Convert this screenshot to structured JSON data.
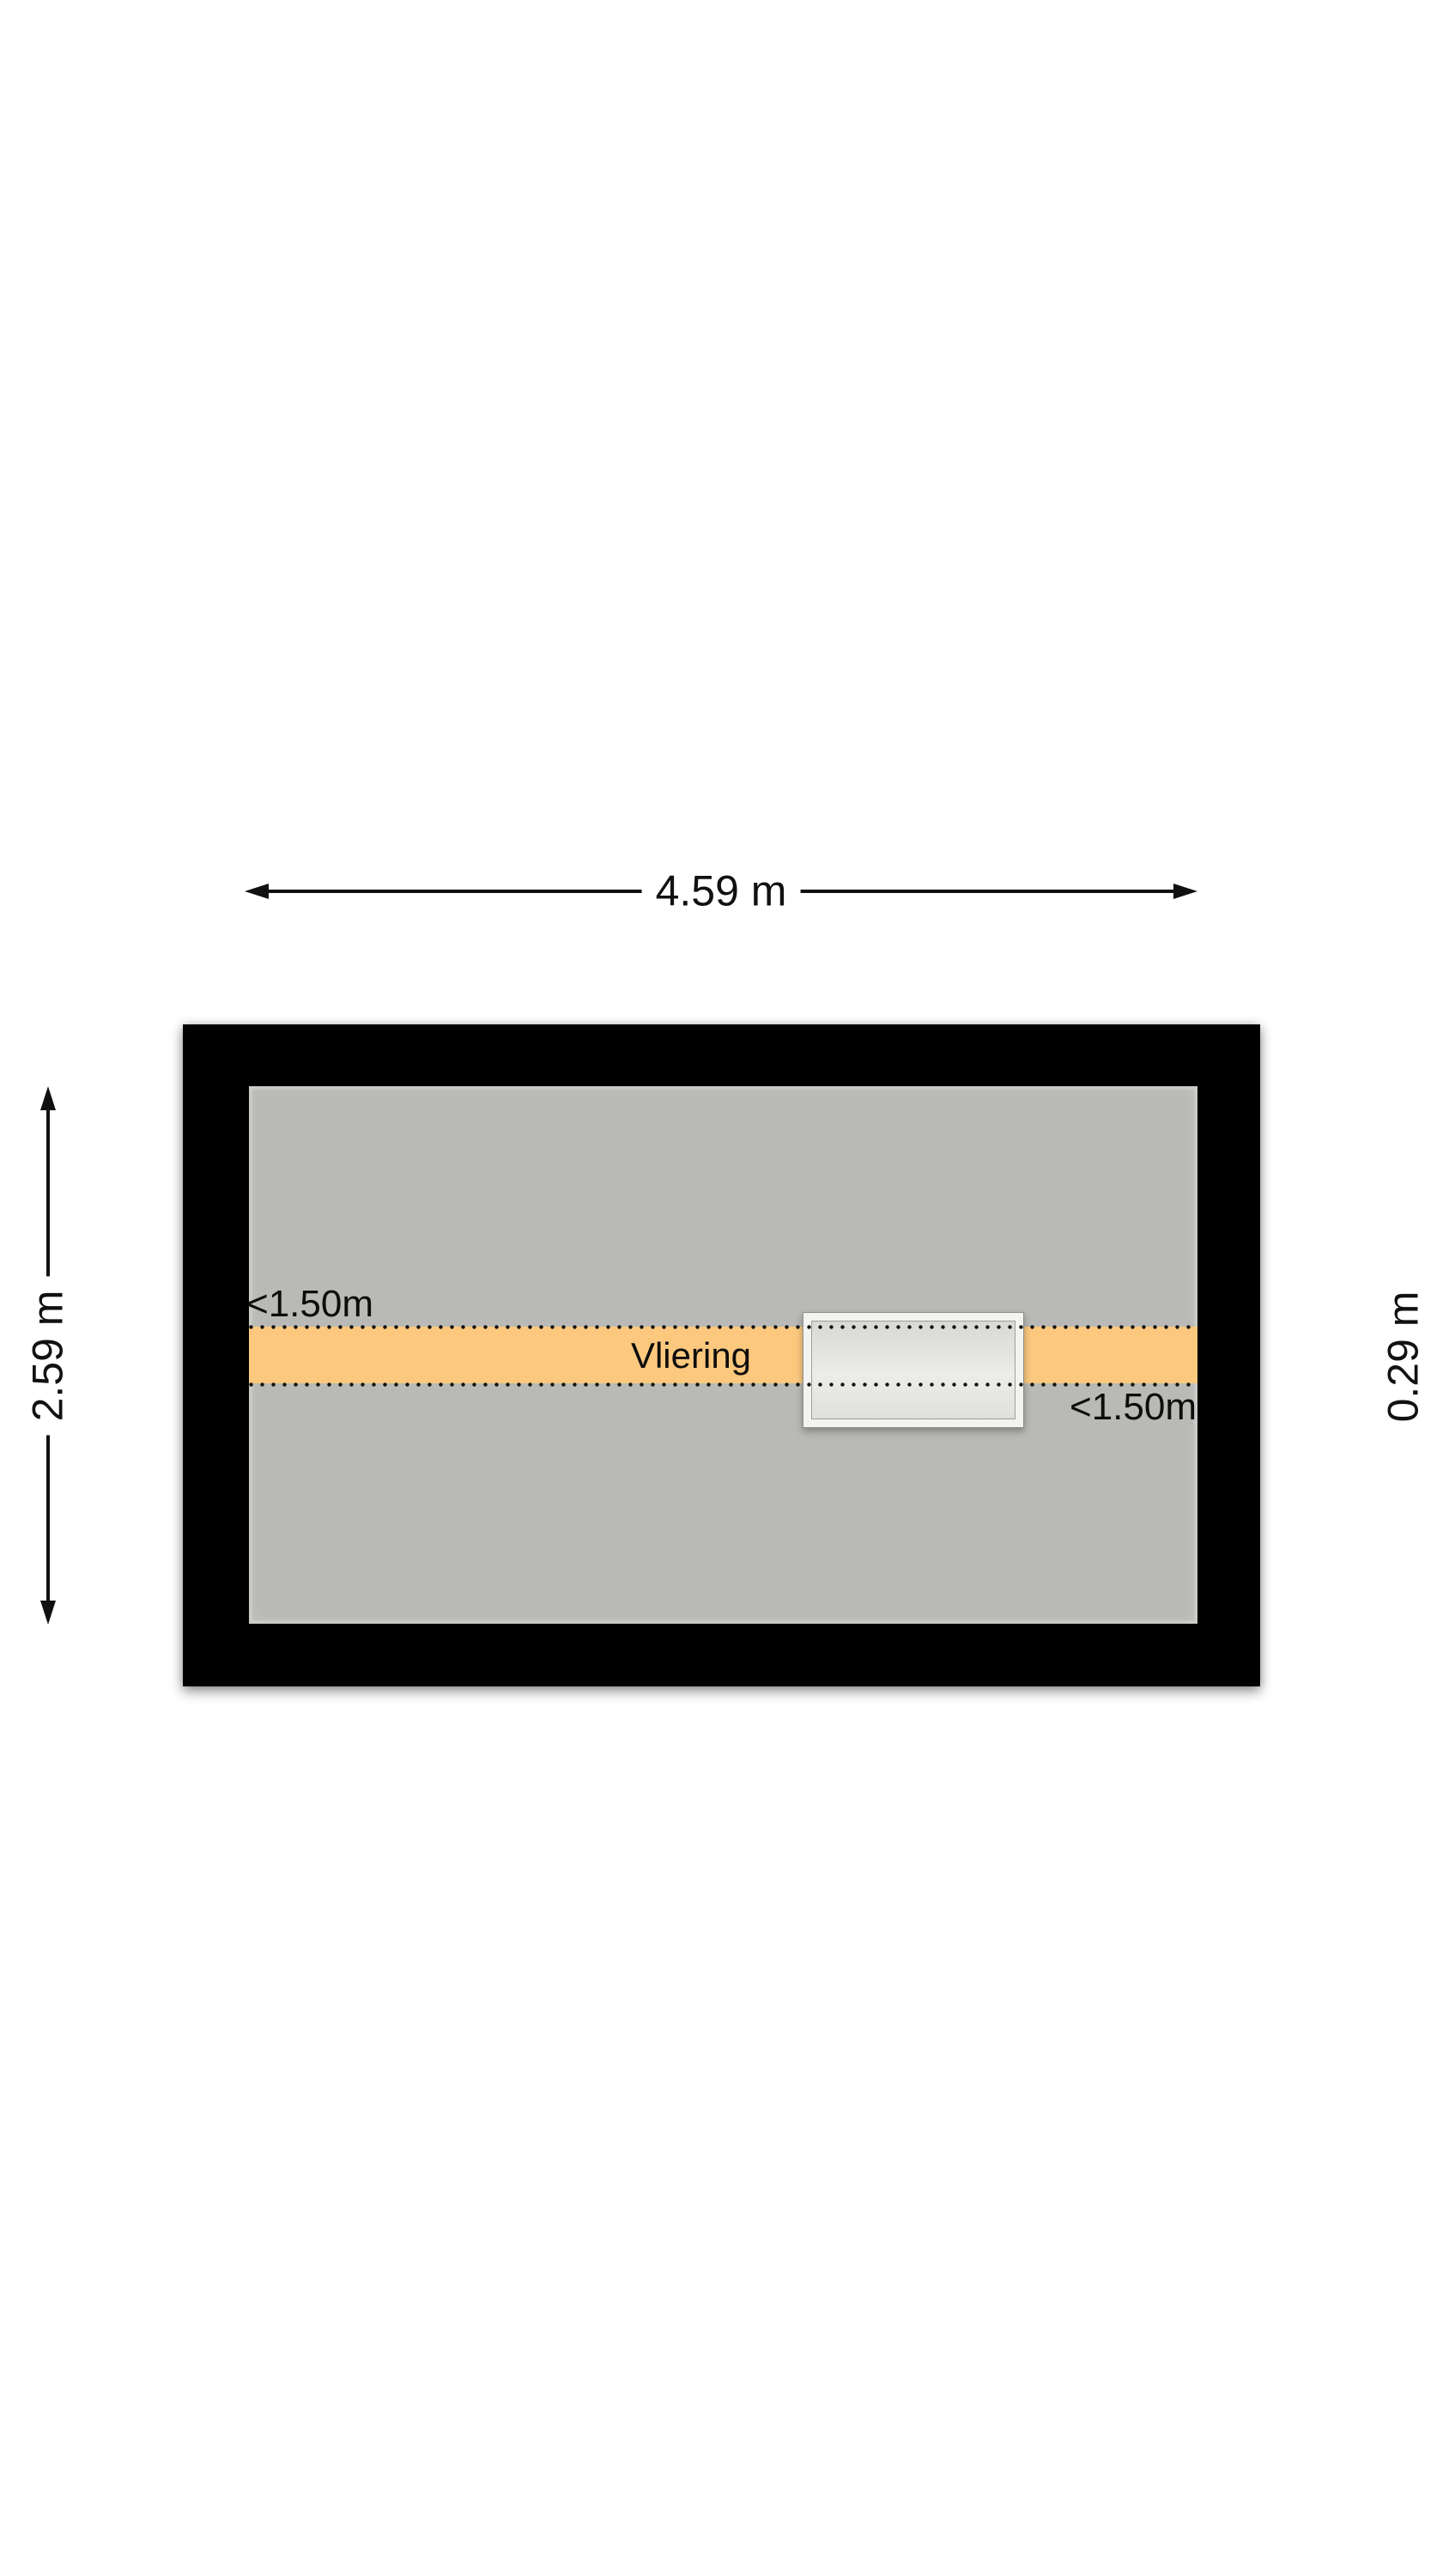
{
  "floorplan": {
    "room": {
      "label": "Vliering"
    },
    "dimensions": {
      "width": "4.59 m",
      "height": "2.59 m",
      "right_offset": "0.29 m"
    },
    "clearance": {
      "top_left": "<1.50m",
      "bottom_right": "<1.50m"
    },
    "colors": {
      "wall": "#000000",
      "floor": "#b9b9b6",
      "attic_band": "#fbc87e",
      "hatch_frame": "#f3f3f1",
      "hatch_fill": "#ececea",
      "dotted_line": "#111111",
      "text": "#111111",
      "background": "#ffffff"
    }
  }
}
